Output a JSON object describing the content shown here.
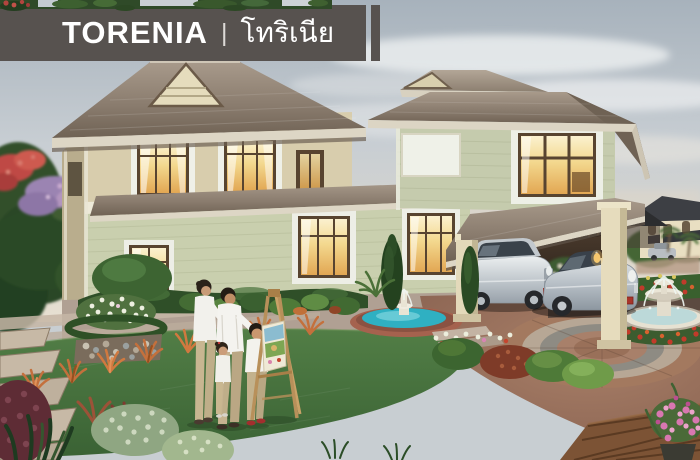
{
  "banner": {
    "title_en": "TORENIA",
    "separator": "|",
    "title_th": "โทริเนีย",
    "background": "#57524f",
    "text_color": "#ffffff"
  },
  "scene": {
    "elements": [
      "two-story-house",
      "tiled-hip-roofs",
      "lit-windows",
      "carport",
      "suv-car",
      "sedan-car",
      "circular-paved-driveway",
      "garden-pond-with-fountain",
      "tiered-stone-fountain",
      "flower-beds",
      "lawn",
      "stone-path",
      "family-of-four",
      "painting-easel",
      "flowering-trees",
      "neighbor-house",
      "gazebo",
      "wood-deck",
      "pink-flower-pot"
    ],
    "palette": {
      "sky": "#c8ced3",
      "roof": "#8b7d6f",
      "wall_upper": "#d8cdad",
      "wall_lower": "#c9cfae",
      "window_glow": "#e8b861",
      "lawn": "#42703c",
      "driveway_brick": "#96705f",
      "car_silver": "#cfd4d8",
      "hedge_green": "#2f4f28",
      "orange_grass": "#c4703c",
      "pond_water": "#2fb0c2",
      "fountain_stone": "#e6e1d2"
    }
  }
}
